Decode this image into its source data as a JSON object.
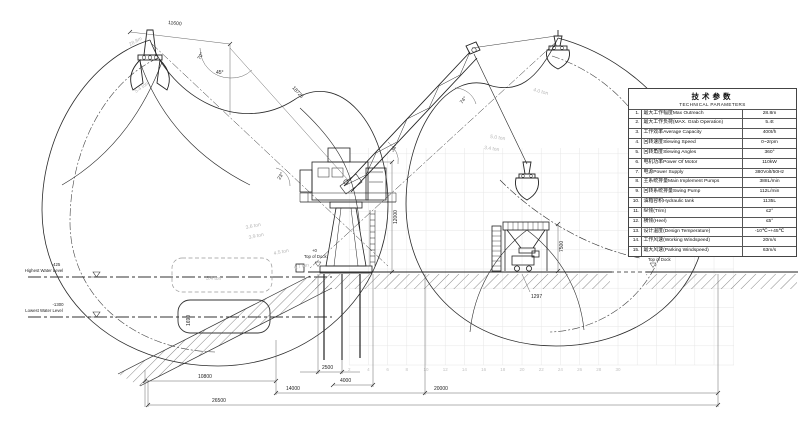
{
  "table": {
    "title": "技术参数",
    "subtitle": "TECHNICAL PARAMETERS",
    "rows": [
      {
        "no": "1.",
        "name": "最大工作幅度Max Outreach",
        "value": "28.8m"
      },
      {
        "no": "2.",
        "name": "最大工作负荷(MAX. Grab Operation)",
        "value": "5.4t"
      },
      {
        "no": "3.",
        "name": "工作效率Average Capacity",
        "value": "400t/h"
      },
      {
        "no": "4.",
        "name": "回转速度Slewing Speed",
        "value": "0~2rpm"
      },
      {
        "no": "5.",
        "name": "回转角度Slewing Angles",
        "value": "360°"
      },
      {
        "no": "6.",
        "name": "电机功率Power Of Motor",
        "value": "110kW"
      },
      {
        "no": "7.",
        "name": "电源Power Supply",
        "value": "380Volt/50Hz"
      },
      {
        "no": "8.",
        "name": "主系统排量Main Implement Pumps",
        "value": "388L/min"
      },
      {
        "no": "9.",
        "name": "回转系统排量Swing Pump",
        "value": "112L/min"
      },
      {
        "no": "10.",
        "name": "油箱容积Hydraulic tank",
        "value": "1135L"
      },
      {
        "no": "11.",
        "name": "纵倾(Trim)",
        "value": "≤2°"
      },
      {
        "no": "12.",
        "name": "横倾(Heel)",
        "value": "≤5°"
      },
      {
        "no": "13.",
        "name": "设计温度(Design Temperature)",
        "value": "-10℃~+45℃"
      },
      {
        "no": "14.",
        "name": "工作风速(Working Windspeed)",
        "value": "20m/s"
      },
      {
        "no": "15.",
        "name": "最大风速(Parking Windspeed)",
        "value": "63m/s"
      }
    ]
  },
  "dimensions": {
    "top_width": "11600",
    "boom_length": "18725",
    "tower_height": "12000",
    "hopper_height": "7500",
    "base_width": "2500",
    "left_bank_span": "10800",
    "hopper_offset": "4000",
    "left_span": "14000",
    "right_span": "20000",
    "total_span": "26500",
    "dock_detail": "1297",
    "barge_depth": "1690"
  },
  "angles": {
    "a70": "70°",
    "a45": "45°",
    "a74": "74°",
    "a34": "34°",
    "a23": "23°"
  },
  "levels": {
    "highest": {
      "elev": "-425",
      "label": "Highest Water Level"
    },
    "lowest": {
      "elev": "-1300",
      "label": "Lowest Water Level"
    },
    "dock_left": {
      "elev": "+0",
      "label": "Top of Dock"
    },
    "dock_right": {
      "elev": "+0",
      "label": "Top of Dock"
    }
  },
  "capacity_labels": [
    "28.8m",
    "5.4 ton",
    "3.6 ton",
    "3.9 ton",
    "4.5 ton",
    "4.7 ton",
    "5.4 ton",
    "5.0 ton",
    "3.4 ton",
    "4.0 ton"
  ],
  "grid_numbers": [
    "2",
    "4",
    "6",
    "8",
    "10",
    "12",
    "14",
    "16",
    "18",
    "20",
    "22",
    "24",
    "26",
    "28",
    "30"
  ]
}
